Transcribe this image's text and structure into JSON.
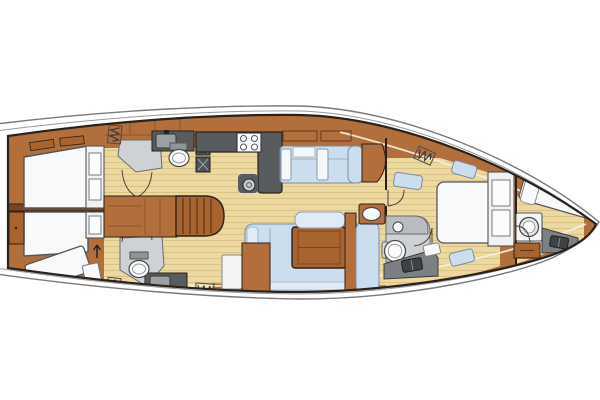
{
  "diagram": {
    "type": "yacht-interior-floor-plan",
    "view": "top-down",
    "orientation": {
      "bow": "right",
      "stern": "left",
      "top_side": "port",
      "bottom_side": "starboard"
    }
  },
  "colors": {
    "hull_outline": "#7a7a7a",
    "deck_line": "#9a9a9a",
    "interior_line": "#2a211a",
    "wood": "#b26f3c",
    "wood_deep": "#7c4521",
    "wood_table": "#a9632f",
    "floor": "#ecd9a2",
    "floor_line": "#c9a96a",
    "counter_dark": "#595c5e",
    "locker_gray": "#7c8083",
    "head_floor": "#ced2d4",
    "fixture_white": "#fafbfc",
    "fixture_stroke": "#4a4a4a",
    "upholstery": "#ccddee",
    "upholstery_light": "#e2ebf5",
    "cushion_white": "#f5f7f9",
    "bed_white": "#f8f9fa",
    "background": "#ffffff"
  },
  "icons": {
    "hatch": "deck-hatch-zigzag-icon",
    "arrow": "companionway-direction-arrow-icon",
    "locker_x": "cold-locker-cross-icon",
    "seacock": "locker-latch-icon"
  },
  "rooms": [
    {
      "id": "aft-cabin-port",
      "name": "Aft guest cabin (port)",
      "fixtures": [
        "double-berth",
        "wardrobe-drawers",
        "shelves",
        "overhead-hatch"
      ]
    },
    {
      "id": "aft-head-port",
      "name": "Aft head (port)",
      "fixtures": [
        "toilet",
        "washbasin-counter",
        "shower-floor",
        "cold-lockers"
      ]
    },
    {
      "id": "aft-cabin-starboard",
      "name": "Aft guest cabin (starboard)",
      "fixtures": [
        "double-berth",
        "angled-berth",
        "side-table",
        "wardrobe-drawers",
        "stern-locker",
        "overhead-hatch"
      ]
    },
    {
      "id": "aft-head-starboard",
      "name": "Aft head (starboard)",
      "fixtures": [
        "toilet",
        "washbasin-counter",
        "shower-floor"
      ]
    },
    {
      "id": "companionway",
      "name": "Companionway",
      "fixtures": [
        "steps",
        "direction-arrow",
        "cabinets"
      ]
    },
    {
      "id": "galley",
      "name": "Galley",
      "fixtures": [
        "l-shaped-counter",
        "four-burner-stove",
        "round-sink",
        "cold-lockers"
      ]
    },
    {
      "id": "saloon",
      "name": "Saloon",
      "fixtures": [
        "straight-settee",
        "u-shaped-dinette",
        "wood-table",
        "chaise-bench",
        "overhead-lockers",
        "washbasin-cabinet",
        "door-panel"
      ]
    },
    {
      "id": "owner-cabin",
      "name": "Forward owner's cabin",
      "fixtures": [
        "island-double-bed",
        "bedside-benches",
        "dresser-drawers",
        "overhead-hatch"
      ]
    },
    {
      "id": "owner-head",
      "name": "Forward head (en suite)",
      "fixtures": [
        "toilet",
        "vanity-basin",
        "wet-locker-band"
      ]
    },
    {
      "id": "forepeak",
      "name": "Forepeak / crew berth",
      "fixtures": [
        "single-berth",
        "pillow",
        "washing-machine",
        "sail-locker",
        "stowage-drawers"
      ]
    }
  ]
}
